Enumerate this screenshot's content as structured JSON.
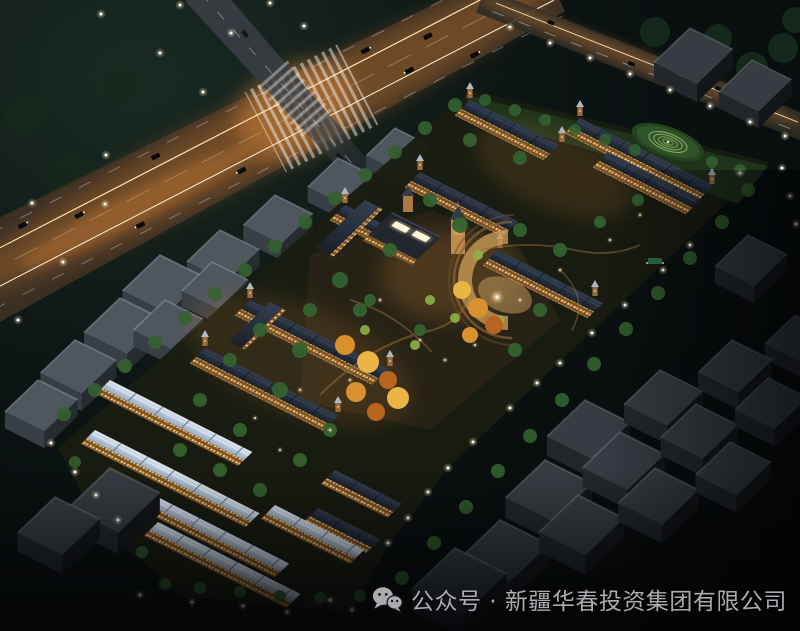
{
  "image": {
    "type": "architectural-rendering",
    "subject": "Aerial night-view rendering of a gated residential compound with illuminated low-rise apartment and townhouse rows, a central clubhouse with clock tower and curved plaza, landscaped gardens, a spiral lawn feature, surrounded by dark unlit city blocks and a glowing arterial highway with an intersection",
    "time_of_day": "night"
  },
  "caption": {
    "icon": "wechat-icon",
    "text": "公众号 · 新疆华春投资集团有限公司"
  },
  "colors": {
    "background": "#050608",
    "sky_top_left": "#1a2a23",
    "sky_base": "#070a0c",
    "asphalt": "#3a2f23",
    "cross_road": "#383d43",
    "road_glow": "#d9802f",
    "road_trail": "#ffab55",
    "road_trail_core": "#ffe3b0",
    "headlight": "#fff3d6",
    "window_light": "#ffd07e",
    "facade": "#7c5328",
    "facade_bright": "#c08b4a",
    "roof_dark_1": "#333e4f",
    "roof_dark_2": "#1b212b",
    "roof_light_1": "#dde7f1",
    "roof_light_2": "#97aac1",
    "tree_dark": "#16281b",
    "tree_green": "#34622f",
    "tree_lit": "#8fb148",
    "autumn_1": "#d9912f",
    "autumn_2": "#eab544",
    "autumn_3": "#b8651f",
    "lawn": "#2f5429",
    "spiral_ring": "#a5c873",
    "plaza": "#c79a55",
    "path_warm": "#8a6a38",
    "concrete_top": "#4e565e",
    "concrete_front": "#383e45",
    "concrete_side": "#262b30",
    "concrete_dark_top": "#363c42",
    "concrete_dark_front": "#23272c",
    "concrete_dark_side": "#131619",
    "lamp_core": "#ffffff",
    "lamp_warm": "#ffd9a0",
    "caption_text": "#b9babd"
  }
}
